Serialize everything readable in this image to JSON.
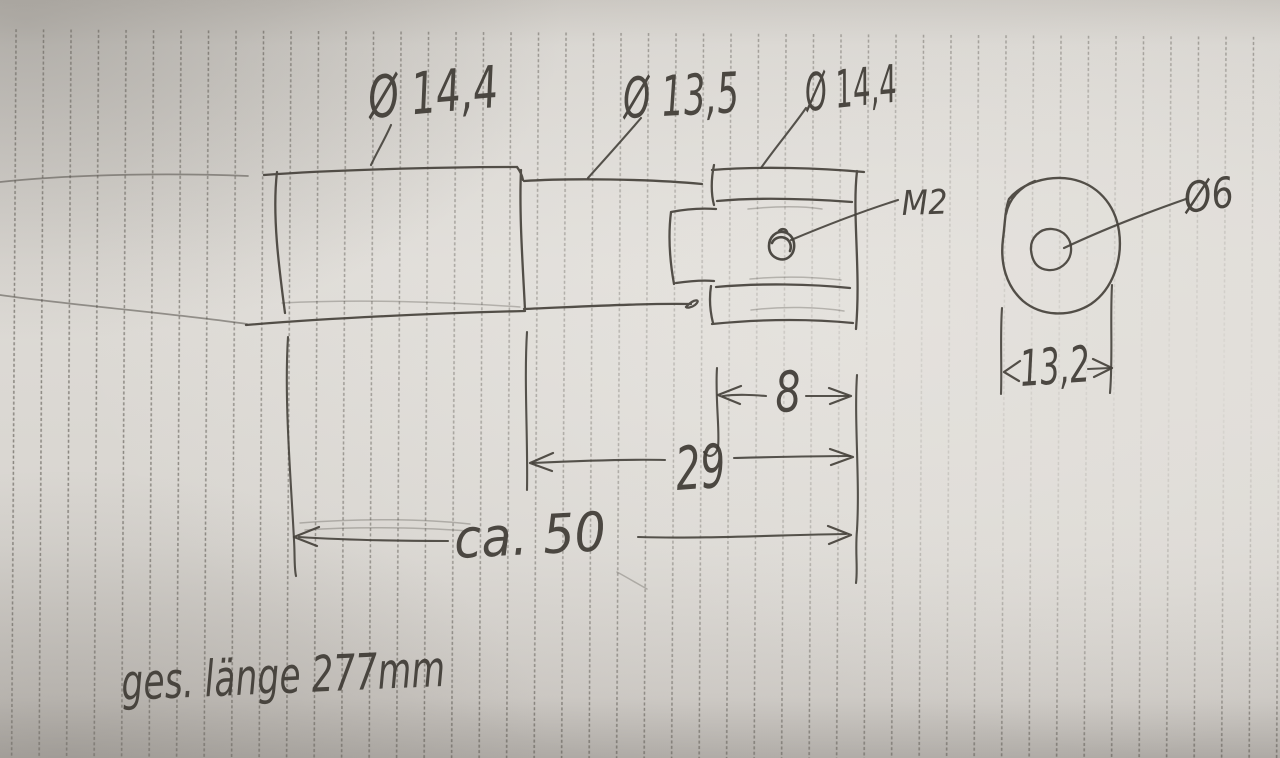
{
  "scene": {
    "description": "Hand-drawn pencil machining sketch of a turned shaft end on vertically ruled note paper",
    "unit": "mm"
  },
  "side_view": {
    "diameter_labels": [
      {
        "label": "Ø 14,4"
      },
      {
        "label": "Ø 13,5"
      },
      {
        "label": "Ø 14,4"
      }
    ],
    "thread_label": "M2",
    "dimensions": {
      "disc_width": "8",
      "section_length": "29",
      "overall_shown": "ca. 50"
    }
  },
  "end_view": {
    "hole_label": "Ø6",
    "width_dimension": "13,2"
  },
  "note": "ges. länge 277mm",
  "colors": {
    "paper": "#dedbd6",
    "pencil": "#45413b",
    "ruling": "#5a564f"
  }
}
